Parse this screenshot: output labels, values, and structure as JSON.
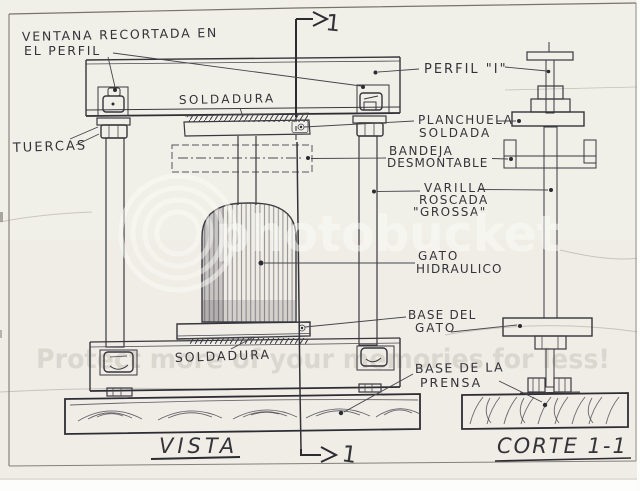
{
  "page": {
    "background_color": "#efede6",
    "ink_color": "#34333a"
  },
  "titles": {
    "vista": "VISTA",
    "corte": "CORTE 1-1"
  },
  "section_markers": {
    "top": "1",
    "bottom": "1"
  },
  "labels": {
    "ventana": [
      "VENTANA RECORTADA EN",
      "EL PERFIL"
    ],
    "soldadura_top": "SOLDADURA",
    "tuercas": "TUERCAS",
    "perfil": "PERFIL \"I\"",
    "planchuela": [
      "PLANCHUELA",
      "SOLDADA"
    ],
    "bandeja": [
      "BANDEJA",
      "DESMONTABLE"
    ],
    "varilla": [
      "VARILLA",
      "ROSCADA",
      "\"GROSSA\""
    ],
    "gato": [
      "GATO",
      "HIDRAULICO"
    ],
    "base_gato": [
      "BASE DEL",
      "GATO"
    ],
    "soldadura_bottom": "SOLDADURA",
    "base_prensa": [
      "BASE DE LA",
      "PRENSA"
    ]
  },
  "watermark": {
    "center": "photobucket",
    "bottom": "Protect more of your memories for less!"
  }
}
